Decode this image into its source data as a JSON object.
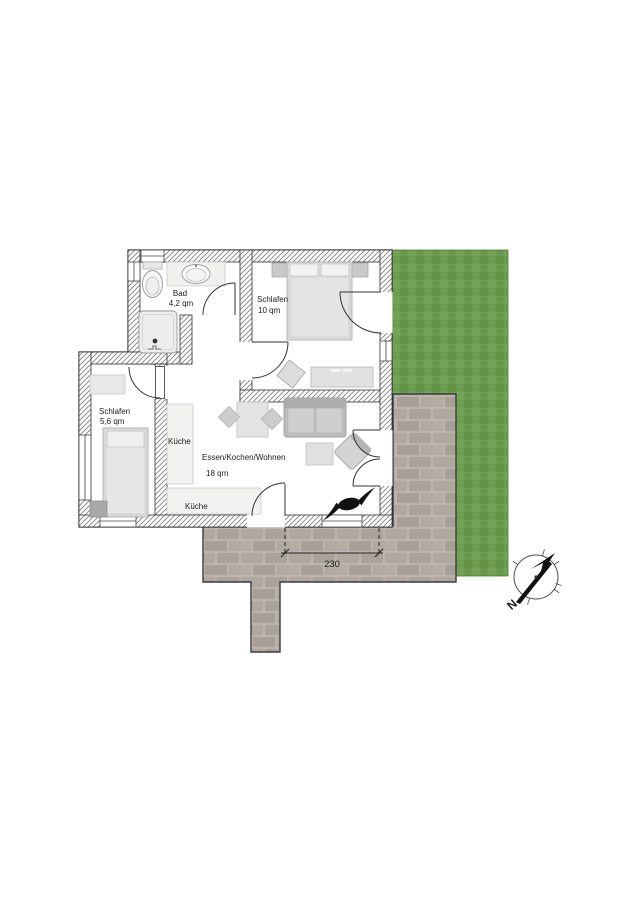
{
  "floorplan": {
    "rooms": [
      {
        "name": "Bad",
        "area": "4,2 qm"
      },
      {
        "name": "Schlafen",
        "area": "10 qm"
      },
      {
        "name": "Schlafen",
        "area": "5,6 qm"
      },
      {
        "name": "Essen/Kochen/Wohnen",
        "area": "18 qm"
      }
    ],
    "kitchen_labels": [
      "Küche",
      "Küche"
    ],
    "dimension_label": "230",
    "compass_north_label": "N",
    "colors": {
      "lawn": "#6b9b4f",
      "terrace_brick": "#b0a79f",
      "terrace_joint": "#beb6ae",
      "wall_hatch_line": "#808080",
      "outline": "#2a2a2a"
    }
  }
}
